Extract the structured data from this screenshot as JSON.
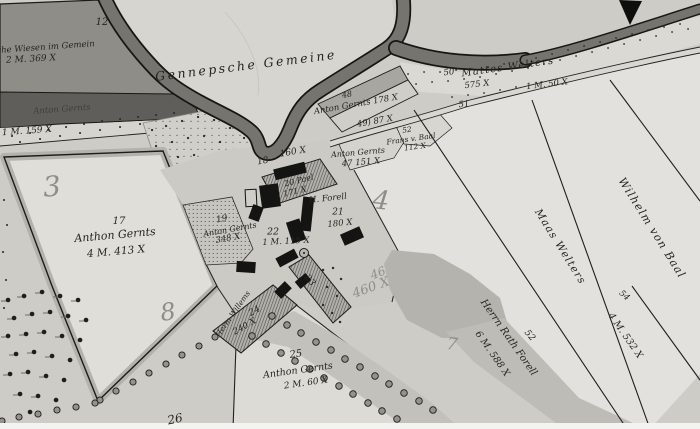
{
  "labels": {
    "n12": "12",
    "wiesen": "sche Wiesen im Gemein",
    "wiesenArea": "2 M. 369 X",
    "gemeine": "Gennepsche Gemeine",
    "bandOwner": "Anton Gernts",
    "bandArea": "1 M. 159 X",
    "n48": "48",
    "owner48": "Anton Gernts 178 X",
    "n49": "49) 87 X",
    "n52": "52",
    "owner52": "Frans v. Baal",
    "area52": "112 X",
    "owner47": "Anton Gernts",
    "n47": "47  151 X",
    "n50": "50",
    "welters": "Mattes Welters",
    "area50": "575 X",
    "area50b": "1 M. 50 X",
    "n51": "51",
    "n18": "18",
    "area18": "160 X",
    "n20": "20 Pael",
    "area20": "171 X",
    "forell21": "H. Forell",
    "n21": "21",
    "area21": "180 X",
    "n22": "22",
    "area22": "1 M. 115 X",
    "n19": "19",
    "owner19": "Anton Gernts",
    "area19": "348 X",
    "n17": "17",
    "owner17": "Anthon Gernts",
    "area17": "4 M. 413 X",
    "n25": "25",
    "owner25": "Anthon Gernts",
    "area25": "2 M. 60 X",
    "n26": "26",
    "owner24": "Herm Willems",
    "n24": "24",
    "area24": "240 X",
    "n23": "23",
    "forellName": "Herrn Rath Forell",
    "forellArea": "6 M. 588 X",
    "n52b": "52",
    "n54": "54",
    "area54": "4 M. 532 X",
    "maas": "Maas Welters",
    "wilhelm": "Wilhelm von Baal",
    "p3": "3",
    "p8": "8",
    "p4": "4",
    "p46": "46",
    "p460": "460 X",
    "p7": "7"
  }
}
